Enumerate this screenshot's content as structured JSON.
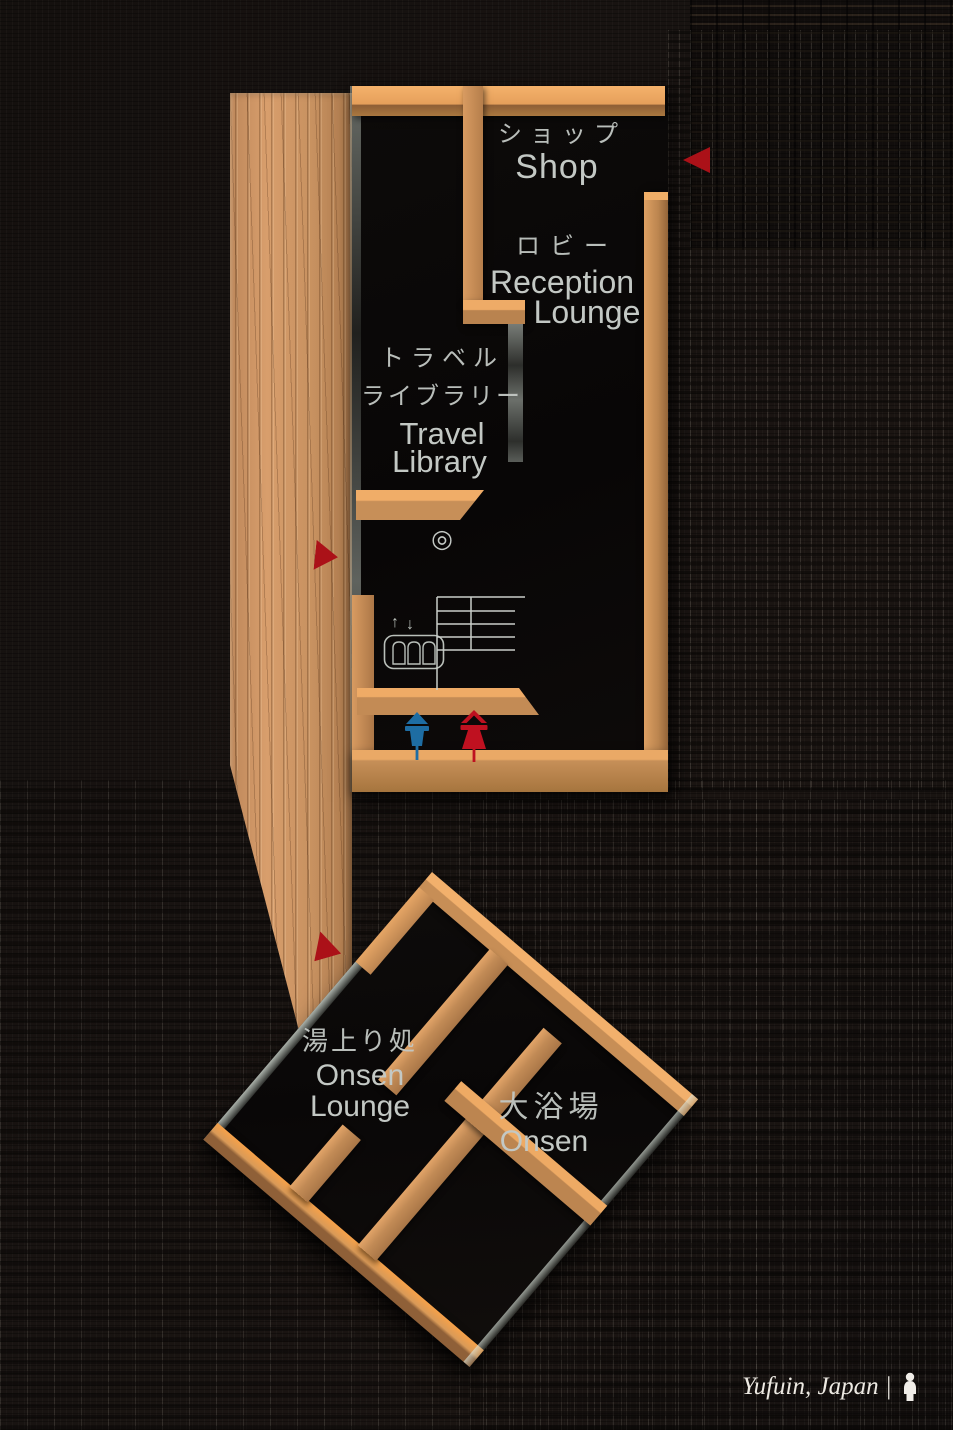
{
  "colors": {
    "wood": "#cf9459",
    "wood_bright": "#eda45f",
    "panel_black": "#0b0908",
    "wall_black": "#171210",
    "text": "#c3c8c4",
    "arrow_red": "#ab1118",
    "male_blue": "#1e6da3",
    "female_red": "#bf1120",
    "glass": "#cfd8cf"
  },
  "upper_map": {
    "shop_jp": "ショップ",
    "shop_en": "Shop",
    "lobby_jp": "ロビー",
    "reception_en": "Reception",
    "reception_lounge_en": "Lounge",
    "travel_jp1": "トラベル",
    "travel_jp2": "ライブラリー",
    "travel_en1": "Travel",
    "travel_en2": "Library",
    "current_location_marker": "◎",
    "elevator_up_arrow": "↑",
    "elevator_down_arrow": "↓"
  },
  "lower_map": {
    "onsen_lounge_jp": "湯上り処",
    "onsen_lounge_en1": "Onsen",
    "onsen_lounge_en2": "Lounge",
    "onsen_jp": "大浴場",
    "onsen_en": "Onsen"
  },
  "caption": {
    "text": "Yufuin, Japan |"
  },
  "icons": {
    "elevator": "elevator-icon",
    "stairs": "stairs-icon",
    "restroom_male": "restroom-male-icon",
    "restroom_female": "restroom-female-icon",
    "direction_arrow": "red-triangle-arrow-icon",
    "location_marker": "double-circle-marker",
    "logo": "photographer-logo-icon"
  }
}
